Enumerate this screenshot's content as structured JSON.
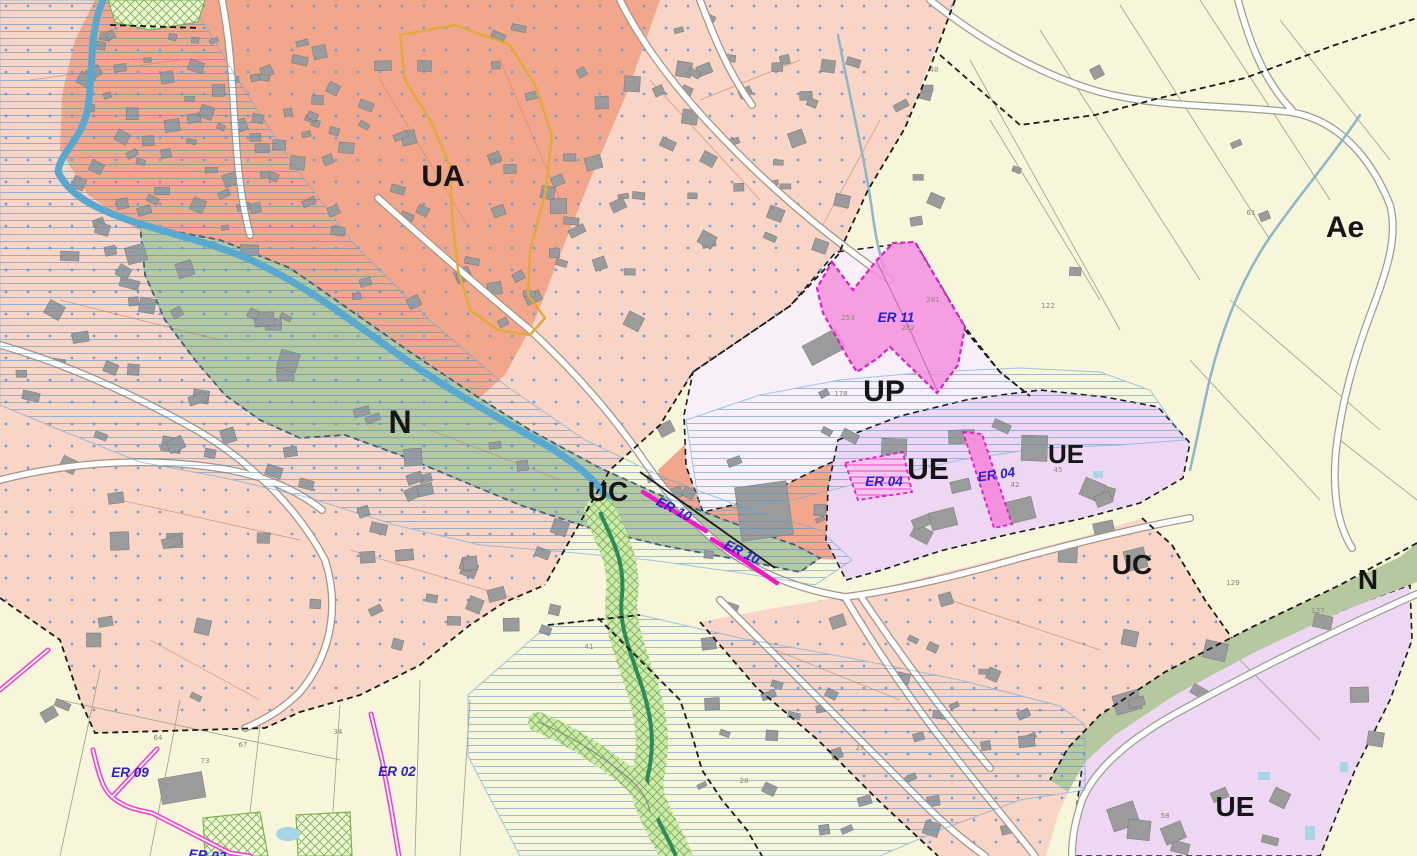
{
  "map": {
    "kind": "urban-planning-zoning-map",
    "zone_labels": [
      {
        "id": "ua",
        "text": "UA",
        "x": 443,
        "y": 186,
        "size": 30
      },
      {
        "id": "n-1",
        "text": "N",
        "x": 400,
        "y": 433,
        "size": 32
      },
      {
        "id": "uc-1",
        "text": "UC",
        "x": 608,
        "y": 501,
        "size": 28
      },
      {
        "id": "up",
        "text": "UP",
        "x": 884,
        "y": 401,
        "size": 30
      },
      {
        "id": "ue-1",
        "text": "UE",
        "x": 928,
        "y": 479,
        "size": 30
      },
      {
        "id": "ue-2",
        "text": "UE",
        "x": 1066,
        "y": 463,
        "size": 26
      },
      {
        "id": "uc-2",
        "text": "UC",
        "x": 1132,
        "y": 574,
        "size": 28
      },
      {
        "id": "n-2",
        "text": "N",
        "x": 1368,
        "y": 589,
        "size": 28
      },
      {
        "id": "ae",
        "text": "Ae",
        "x": 1345,
        "y": 237,
        "size": 30
      },
      {
        "id": "ue-3",
        "text": "UE",
        "x": 1235,
        "y": 816,
        "size": 28
      }
    ],
    "er_labels": [
      {
        "id": "er-11",
        "text": "ER 11",
        "x": 896,
        "y": 322,
        "rot": 0
      },
      {
        "id": "er-04-a",
        "text": "ER 04",
        "x": 884,
        "y": 486,
        "rot": 0
      },
      {
        "id": "er-04-b",
        "text": "ER 04",
        "x": 997,
        "y": 479,
        "rot": -8
      },
      {
        "id": "er-10-a",
        "text": "ER 10",
        "x": 672,
        "y": 513,
        "rot": 27
      },
      {
        "id": "er-10-b",
        "text": "ER 10",
        "x": 740,
        "y": 556,
        "rot": 27
      },
      {
        "id": "er-09",
        "text": "ER 09",
        "x": 130,
        "y": 777,
        "rot": 0
      },
      {
        "id": "er-02",
        "text": "ER 02",
        "x": 397,
        "y": 776,
        "rot": 0
      },
      {
        "id": "er-03",
        "text": "ER 03",
        "x": 207,
        "y": 860,
        "rot": 5
      }
    ],
    "parcel_numbers": [
      {
        "text": "191",
        "x": 495,
        "y": 163
      },
      {
        "text": "48",
        "x": 934,
        "y": 72
      },
      {
        "text": "253",
        "x": 848,
        "y": 320
      },
      {
        "text": "282",
        "x": 908,
        "y": 330
      },
      {
        "text": "281",
        "x": 933,
        "y": 302
      },
      {
        "text": "122",
        "x": 1048,
        "y": 308
      },
      {
        "text": "178",
        "x": 841,
        "y": 396
      },
      {
        "text": "61",
        "x": 1251,
        "y": 215
      },
      {
        "text": "41",
        "x": 589,
        "y": 649
      },
      {
        "text": "34",
        "x": 338,
        "y": 734
      },
      {
        "text": "27",
        "x": 860,
        "y": 750
      },
      {
        "text": "28",
        "x": 744,
        "y": 783
      },
      {
        "text": "129",
        "x": 1233,
        "y": 585
      },
      {
        "text": "127",
        "x": 1318,
        "y": 613
      },
      {
        "text": "58",
        "x": 1165,
        "y": 818
      },
      {
        "text": "42",
        "x": 1015,
        "y": 487
      },
      {
        "text": "45",
        "x": 1058,
        "y": 472
      },
      {
        "text": "64",
        "x": 158,
        "y": 740
      },
      {
        "text": "67",
        "x": 243,
        "y": 747
      },
      {
        "text": "73",
        "x": 205,
        "y": 763
      }
    ],
    "colors": {
      "zone_ua": "#f2a78c",
      "zone_uc": "#f8d5c6",
      "zone_ue": "#eed7f2",
      "zone_up": "#f8eff9",
      "zone_n_green": "#b5c8a0",
      "zone_a_yellow": "#f7f5da",
      "er_fill": "#f590de",
      "er_border": "#e01ec4",
      "flood_stripe": "#4a90c8",
      "parcel_dot": "#6f9fd8",
      "building": "#9b9b9b",
      "road": "#ffffff",
      "river": "#58a8d0",
      "green_corridor": "#79b34c",
      "zone_label": "#161616",
      "er_label": "#2a1fd4",
      "orange_boundary": "#e2a93b"
    }
  }
}
